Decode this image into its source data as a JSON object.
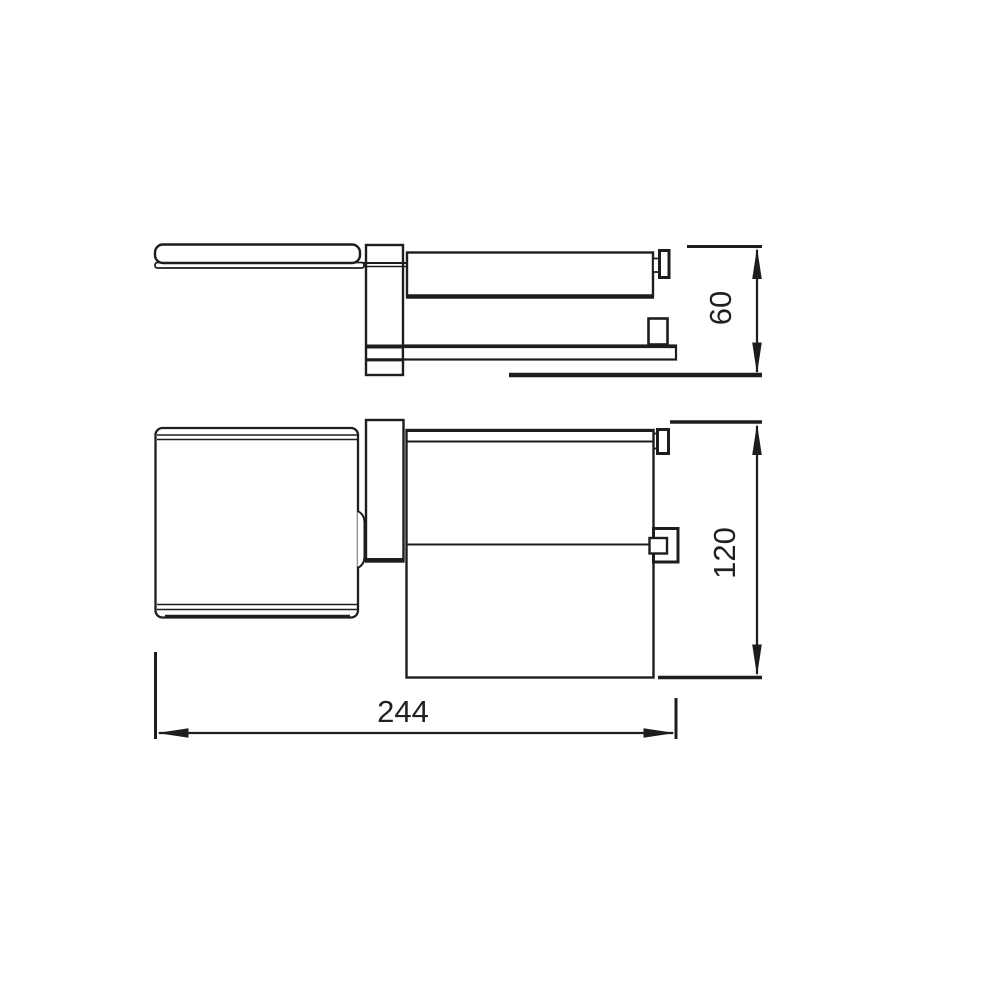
{
  "drawing": {
    "type": "technical-dimension-drawing",
    "views": {
      "top_view": "side profile of wall-mounted paper holder with lid, roll bar and lower rail",
      "front_view": "front elevation of paper holder with cover and roll housing"
    },
    "dimensions": {
      "width": "244",
      "upper_height": "60",
      "overall_height": "120"
    },
    "colors": {
      "line": "#1d1d1b",
      "text": "#231f20",
      "background": "#ffffff"
    }
  }
}
